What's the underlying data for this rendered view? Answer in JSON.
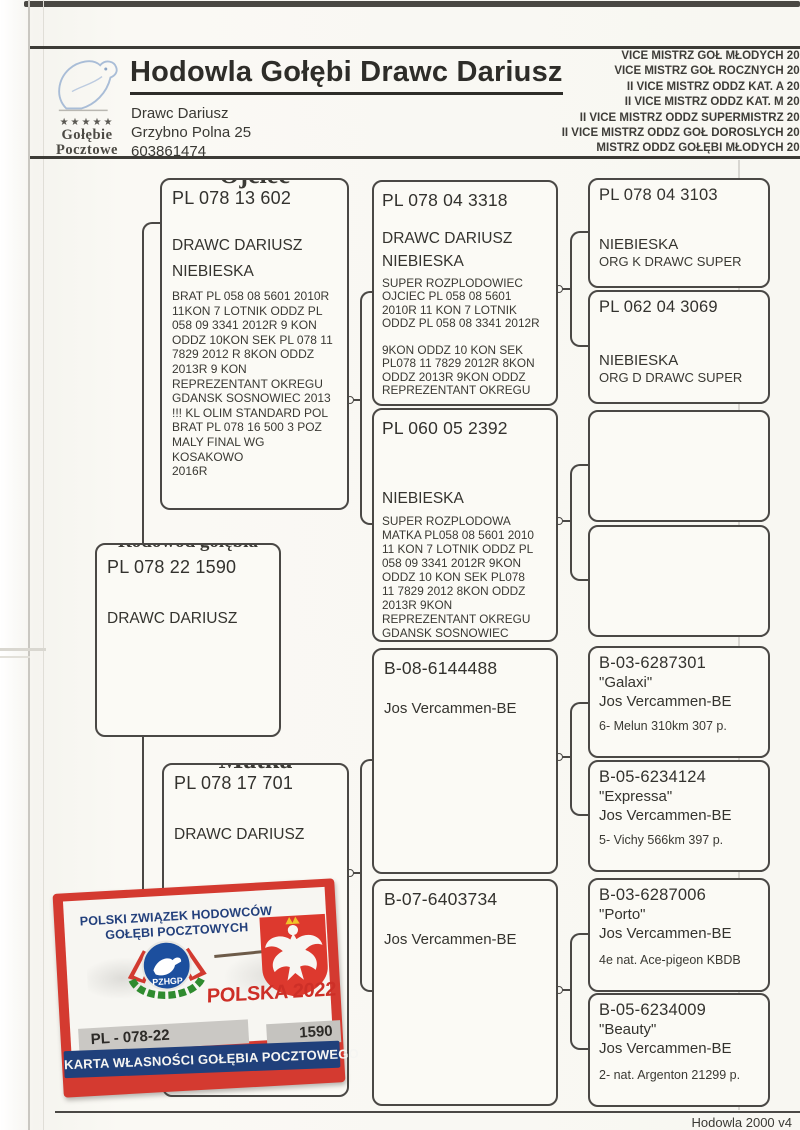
{
  "header": {
    "title": "Hodowla Gołębi Drawc Dariusz",
    "owner": {
      "name": "Drawc Dariusz",
      "address": "Grzybno Polna 25",
      "phone": "603861474"
    },
    "logo": {
      "stars": "★★★★★",
      "line1": "Gołębie",
      "line2": "Pocztowe"
    },
    "achievements": [
      "VICE MISTRZ GOŁ MŁODYCH 201",
      "VICE MISTRZ GOŁ ROCZNYCH 201",
      "II VICE MISTRZ ODDZ KAT. A  201",
      "II VICE MISTRZ ODDZ KAT. M 201",
      "II VICE MISTRZ ODDZ SUPERMISTRZ 201",
      "II VICE MISTRZ ODDZ GOŁ DOROSLYCH 201",
      "MISTRZ ODDZ GOŁĘBI MŁODYCH 201"
    ]
  },
  "pedigree": {
    "subject": {
      "label": "Rodowód gołębia",
      "ring": "PL 078 22 1590",
      "owner": "DRAWC DARIUSZ"
    },
    "father": {
      "label": "Ojciec",
      "ring": "PL 078 13 602",
      "owner": "DRAWC DARIUSZ",
      "color": "NIEBIESKA",
      "info": "BRAT PL 058 08 5601 2010R\n11KON 7 LOTNIK ODDZ PL\n058 09 3341 2012R 9 KON\nODDZ 10KON SEK PL 078 11\n7829 2012 R 8KON ODDZ\n2013R 9 KON\nREPREZENTANT OKREGU\nGDANSK SOSNOWIEC 2013\n!!! KL OLIM STANDARD POL\nBRAT PL 078 16 500 3 POZ\nMALY FINAL WG\nKOSAKOWO\n2016R"
    },
    "mother": {
      "label": "Matka",
      "ring": "PL 078 17 701",
      "owner": "DRAWC DARIUSZ"
    },
    "ff": {
      "label": "O",
      "ring": "PL 078 04 3318",
      "owner": "DRAWC DARIUSZ",
      "color": "NIEBIESKA",
      "info": "SUPER ROZPLODOWIEC\nOJCIEC PL 058 08 5601\n2010R 11 KON 7 LOTNIK\nODDZ PL 058 08 3341 2012R\n\n9KON ODDZ 10 KON SEK\nPL078 11 7829 2012R 8KON\nODDZ 2013R 9KON ODDZ\nREPREZENTANT OKREGU"
    },
    "fm": {
      "label": "M",
      "ring": "PL 060 05 2392",
      "color": "NIEBIESKA",
      "info": "SUPER ROZPLODOWA\nMATKA PL058 08 5601 2010\n11 KON 7 LOTNIK ODDZ PL\n058 09 3341 2012R 9KON\nODDZ 10 KON SEK PL078\n11 7829 2012 8KON ODDZ\n2013R 9KON\nREPREZENTANT OKREGU\nGDANSK SOSNOWIEC"
    },
    "fff": {
      "label": "o",
      "ring": "PL 078 04  3103",
      "color": "NIEBIESKA",
      "org": "ORG K DRAWC   SUPER"
    },
    "ffm": {
      "label": "M",
      "ring": "PL 062 04  3069",
      "color": "NIEBIESKA",
      "org": "ORG D  DRAWC  SUPER"
    },
    "fmf": {
      "label": "O"
    },
    "fmm": {
      "label": "M"
    },
    "mf": {
      "label": "O",
      "ring": "B-08-6144488",
      "owner": "Jos Vercammen-BE"
    },
    "mm": {
      "label": "M",
      "ring": "B-07-6403734",
      "owner": "Jos Vercammen-BE"
    },
    "mff": {
      "label": "o",
      "ring": "B-03-6287301",
      "name": "\"Galaxi\"",
      "owner": "Jos Vercammen-BE",
      "result": "6- Melun 310km 307 p."
    },
    "mfm": {
      "label": "M",
      "ring": "B-05-6234124",
      "name": "\"Expressa\"",
      "owner": "Jos Vercammen-BE",
      "result": "5- Vichy 566km 397 p."
    },
    "mmf": {
      "label": "o",
      "ring": "B-03-6287006",
      "name": "\"Porto\"",
      "owner": "Jos Vercammen-BE",
      "result": "4e nat. Ace-pigeon KBDB"
    },
    "mmm": {
      "label": "M",
      "ring": "B-05-6234009",
      "name": "\"Beauty\"",
      "owner": "Jos Vercammen-BE",
      "result": "2- nat. Argenton 21299 p."
    }
  },
  "card": {
    "org_line1": "POLSKI ZWIĄZEK HODOWCÓW",
    "org_line2": "GOŁĘBI POCZTOWYCH",
    "emblem_text": "PZHGP",
    "country_year": "POLSKA 2022",
    "ring_prefix": "PL - 078-22",
    "ring_number": "1590",
    "banner": "KARTA WŁASNOŚCI GOŁĘBIA POCZTOWEGO"
  },
  "footer": {
    "label": "Hodowla 2000 v4"
  }
}
